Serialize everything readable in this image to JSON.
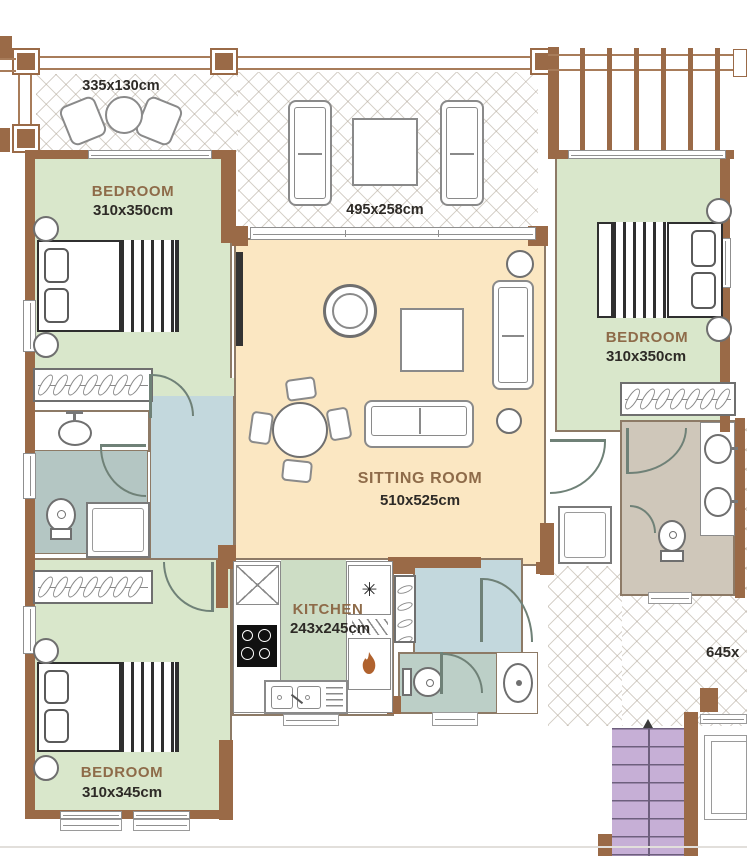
{
  "colors": {
    "wall_brown": "#9a6a47",
    "bedroom_green": "#d9e7cb",
    "kitchen_green": "#cdddc5",
    "sitting_cream": "#fbe7c2",
    "hall_blue": "#c3d8dd",
    "bath_gray": "#b4c6c3",
    "wc_gray": "#bccfc7",
    "bath_taupe": "#cfc7ba",
    "stairs_purple": "#c6afd6",
    "label_brown": "#8e6b49",
    "label_dark": "#2d2a26"
  },
  "rooms": {
    "balcony_top_left": {
      "dims": "335x130cm"
    },
    "balcony_top_center": {
      "dims": "495x258cm"
    },
    "bedroom_top_left": {
      "name": "BEDROOM",
      "dims": "310x350cm"
    },
    "bedroom_right": {
      "name": "BEDROOM",
      "dims": "310x350cm"
    },
    "sitting_room": {
      "name": "SITTING ROOM",
      "dims": "510x525cm"
    },
    "kitchen": {
      "name": "KITCHEN",
      "dims": "243x245cm"
    },
    "bedroom_bottom_left": {
      "name": "BEDROOM",
      "dims": "310x345cm"
    },
    "terrace_right": {
      "dims": "645x"
    }
  },
  "symbols": {
    "freezer": "✳"
  }
}
